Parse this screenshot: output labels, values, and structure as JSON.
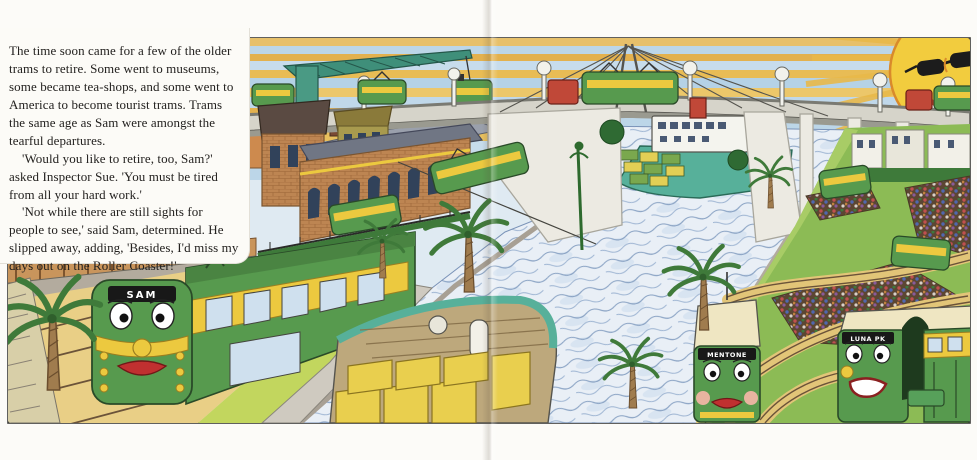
{
  "page": {
    "kind": "children's picture-book spread",
    "background_color": "#fcfbf8"
  },
  "story": {
    "paragraphs": [
      "The time soon came for a few of the older trams to retire. Some went to museums, some became tea-shops, and some went to America to become tourist trams. Trams the same age as Sam were amongst the tearful departures.",
      "'Would you like to retire, too, Sam?' asked Inspector Sue. 'You must be tired from all your hard work.'",
      "'Not while there are still sights for people to see,' said Sam, determined. He slipped away, adding, 'Besides, I'd miss my days out on the Roller Coaster!'"
    ]
  },
  "illustration": {
    "description": "Hand-coloured drawing: a smiling sun in sunglasses over a striped sunset sky; a green dock crane lifts a retired tram; a cable-stayed flyover carries trams and trucks over a wavy river with a container ship and a crate barge; a red-brick depot, palm trees, and seaside gardens with winding tram tracks; three green W-class trams with faces.",
    "colors": {
      "sky_blue": "#bdd7e9",
      "sky_gold": "#e4b44e",
      "sun": "#f2cc3e",
      "crane": "#3f8f7a",
      "river": "#e9eff6",
      "wave": "#8aa3c4",
      "tram_green": "#579a4e",
      "tram_yellow": "#ecc93f",
      "brick": "#bd8552",
      "grass": "#8cbb55",
      "sand": "#e9cf86"
    },
    "trams": [
      {
        "id": "sam",
        "board": "SAM"
      },
      {
        "id": "park-tram-left",
        "board": "MENTONE"
      },
      {
        "id": "park-tram-right",
        "board": "LUNA PK"
      }
    ]
  }
}
